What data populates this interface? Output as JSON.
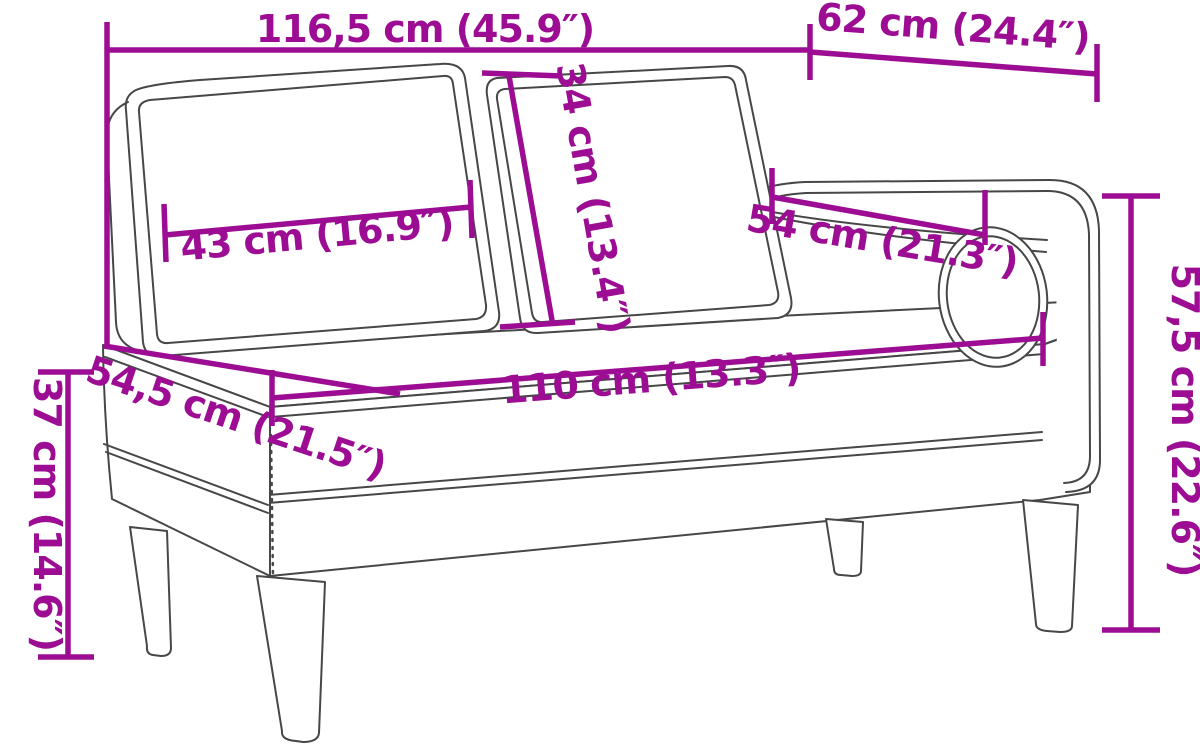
{
  "diagram": {
    "title": "chaise-lounge-dimension-diagram",
    "accent_color": "#9C0D94",
    "outline_color": "#474747",
    "background_color": "#FFFFFF",
    "dimensions": [
      {
        "id": "overall-width",
        "label": "116,5 cm (45.9″)"
      },
      {
        "id": "armrest-side-depth",
        "label": "62 cm (24.4″)"
      },
      {
        "id": "back-cushion-height",
        "label": "34 cm (13.4″)"
      },
      {
        "id": "back-cushion-width",
        "label": "43 cm (16.9″)"
      },
      {
        "id": "armrest-length",
        "label": "54 cm (21.3″)"
      },
      {
        "id": "seat-length",
        "label": "110 cm (13.3″)"
      },
      {
        "id": "seat-depth",
        "label": "54,5 cm (21.5″)"
      },
      {
        "id": "seat-height",
        "label": "37 cm (14.6″)"
      },
      {
        "id": "overall-height",
        "label": "57,5 cm (22.6″)"
      }
    ]
  }
}
